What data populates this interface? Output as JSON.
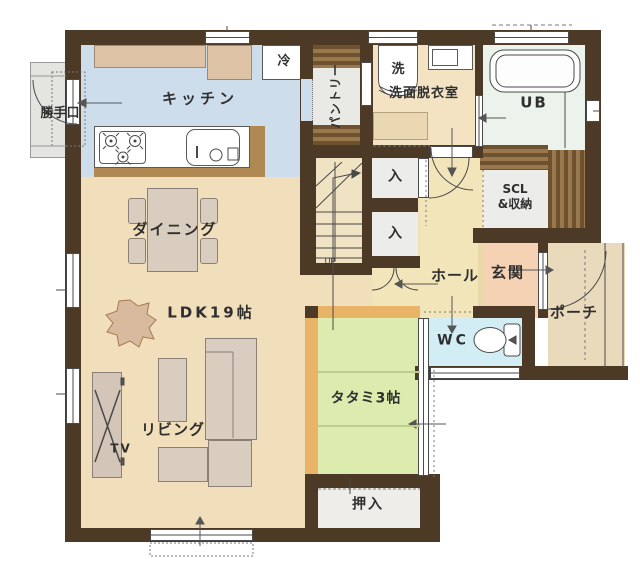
{
  "floorplan": {
    "rooms": {
      "katteguchi": "勝手口",
      "kitchen": "キッチン",
      "fridge": "冷",
      "pantry": "パントリー",
      "washer": "洗",
      "washroom": "洗面脱衣室",
      "unit_bath": "UB",
      "closet_upper": "入",
      "closet_lower": "入",
      "scl": "SCL\n&収納",
      "dining": "ダイニング",
      "ldk": "LDK19帖",
      "hall": "ホール",
      "entrance": "玄関",
      "porch": "ポーチ",
      "toilet": "WC",
      "tatami": "タタミ3帖",
      "living": "リビング",
      "tv": "TV",
      "oshiire": "押入",
      "stairs_direction": "UP"
    },
    "colors": {
      "wall": "#4d3a26",
      "kitchen_floor": "#cdddec",
      "ldk_floor": "#f1debb",
      "pantry_floor": "#e9e9e5",
      "washroom_floor": "#f4e3c3",
      "ub_floor": "#ecf2ec",
      "hall_floor": "#f3e5ba",
      "genkan_floor": "#f5d2b4",
      "genkan_step": "#e9d8a8",
      "porch_floor": "#eadabc",
      "wc_floor": "#d2eef4",
      "tatami_floor": "#dcecae",
      "tatami_frame": "#e9b468",
      "closet_floor": "#ececea",
      "oshiire_floor": "#eeedea",
      "stairs_floor": "#f0e3c4",
      "counter": "#dfc3a6",
      "counter_edge": "#b08952",
      "furniture": "#d9cdbf",
      "outdoor_step": "#e4e4e1",
      "plant": "#d8bb9e"
    }
  }
}
